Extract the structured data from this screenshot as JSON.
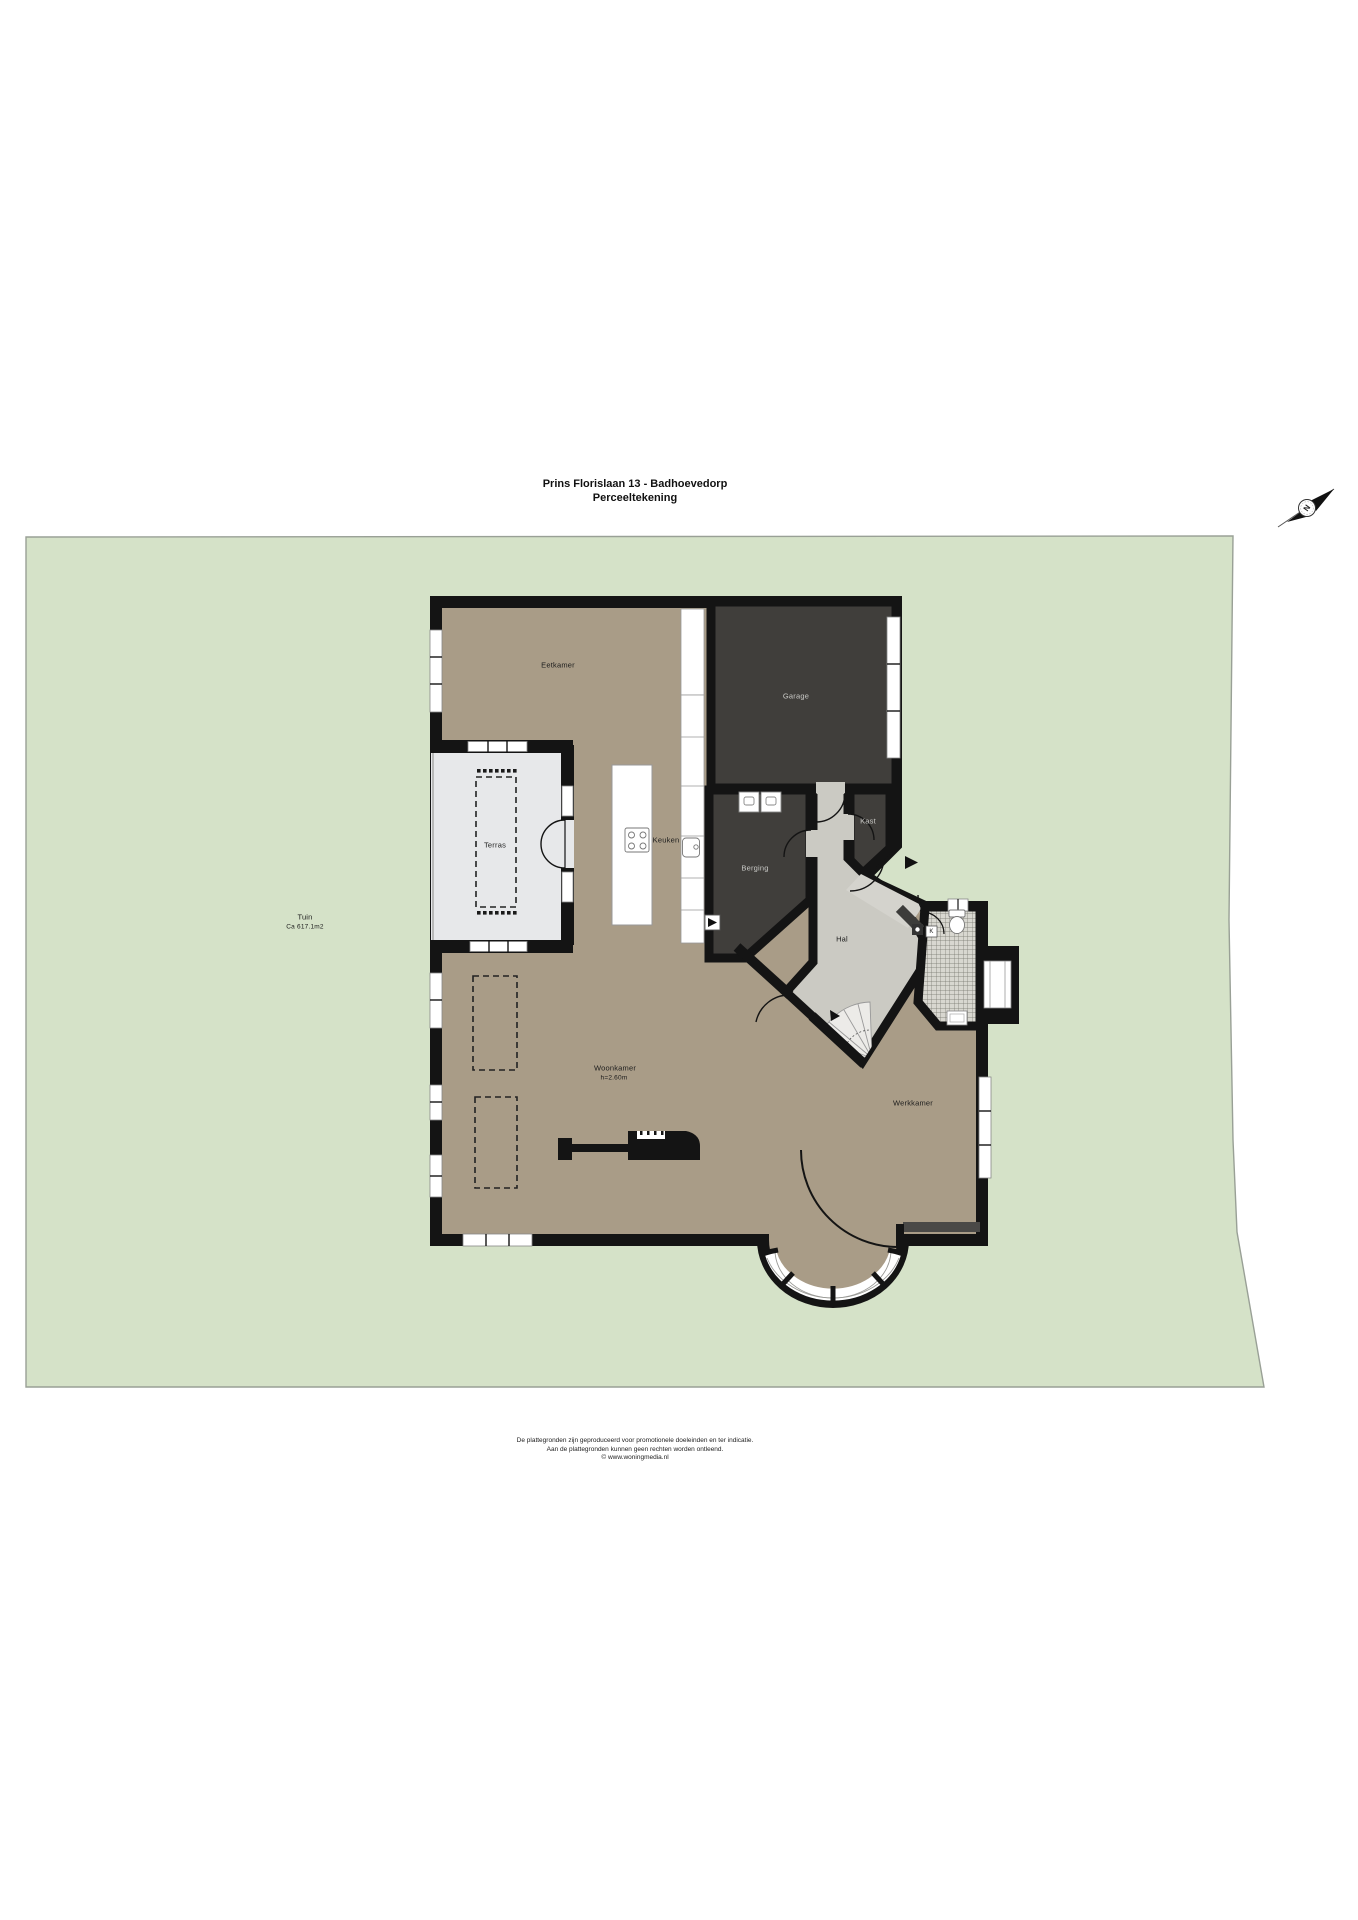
{
  "title": {
    "line1": "Prins Florislaan 13 - Badhoevedorp",
    "line2": "Perceeltekening"
  },
  "rooms": {
    "eetkamer": "Eetkamer",
    "garage": "Garage",
    "terras": "Terras",
    "keuken": "Keuken",
    "berging": "Berging",
    "kast": "Kast",
    "hal": "Hal",
    "woonkamer": "Woonkamer",
    "woonkamer_height": "h=2.60m",
    "werkkamer": "Werkkamer",
    "meter_box": "K"
  },
  "garden": {
    "line1": "Tuin",
    "line2": "Ca 617.1m2"
  },
  "compass": {
    "letter": "N"
  },
  "footer": {
    "line1": "De plattegronden zijn geproduceerd voor promotionele doeleinden en ter indicatie.",
    "line2": "Aan de plattegronden kunnen geen rechten worden ontleend.",
    "line3": "© www.woningmedia.nl"
  },
  "colors": {
    "garden": "#d5e2c8",
    "garden_border": "#99a096",
    "floor": "#a99c87",
    "dark_room": "#403e3b",
    "wall": "#141414",
    "terrace": "#e7e8ea",
    "hall": "#cbcac3",
    "walkway": "#d4d3cd",
    "tile_base": "#d8d7d0"
  }
}
